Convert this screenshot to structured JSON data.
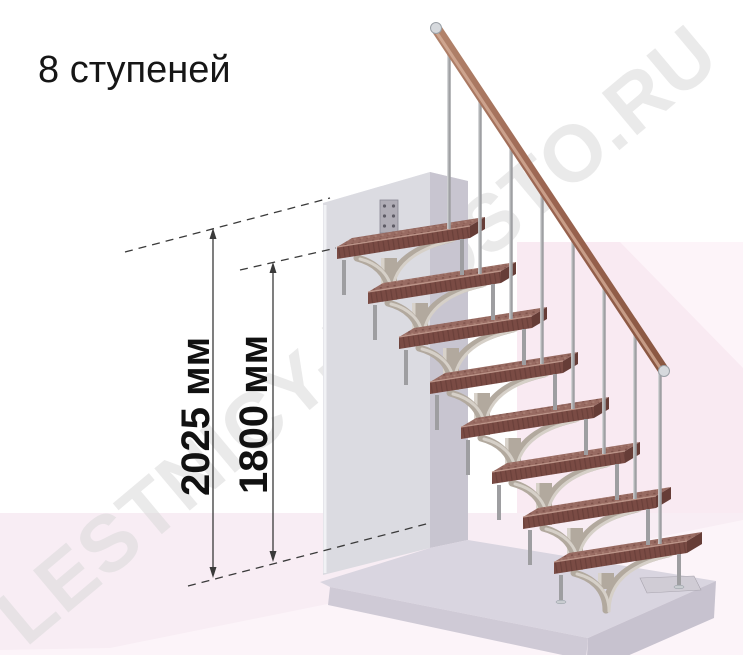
{
  "title": "8 ступеней",
  "steps_count": 8,
  "watermark": "LESTNICY-PROSTO.RU",
  "dimensions": {
    "total_height_label": "2025 мм",
    "upper_tread_height_label": "1800 мм"
  },
  "colors": {
    "background": "#ffffff",
    "floor_pink": "#f8edf4",
    "floor_pink_light": "#fcf4f9",
    "right_wall_pink": "#f9eaf2",
    "wall_gray": "#dbdbe1",
    "wall_side_gray": "#c8c5d0",
    "slab_gray": "#d9d5e0",
    "tread_brown": "#986b62",
    "tread_front_brown": "#7a4b44",
    "handrail_brown": "#9a6450",
    "metal_gray": "#9fa0a3",
    "dimension_line": "#3a3a3a",
    "watermark_gray": "#d8d8d8",
    "title_text": "#161616"
  }
}
